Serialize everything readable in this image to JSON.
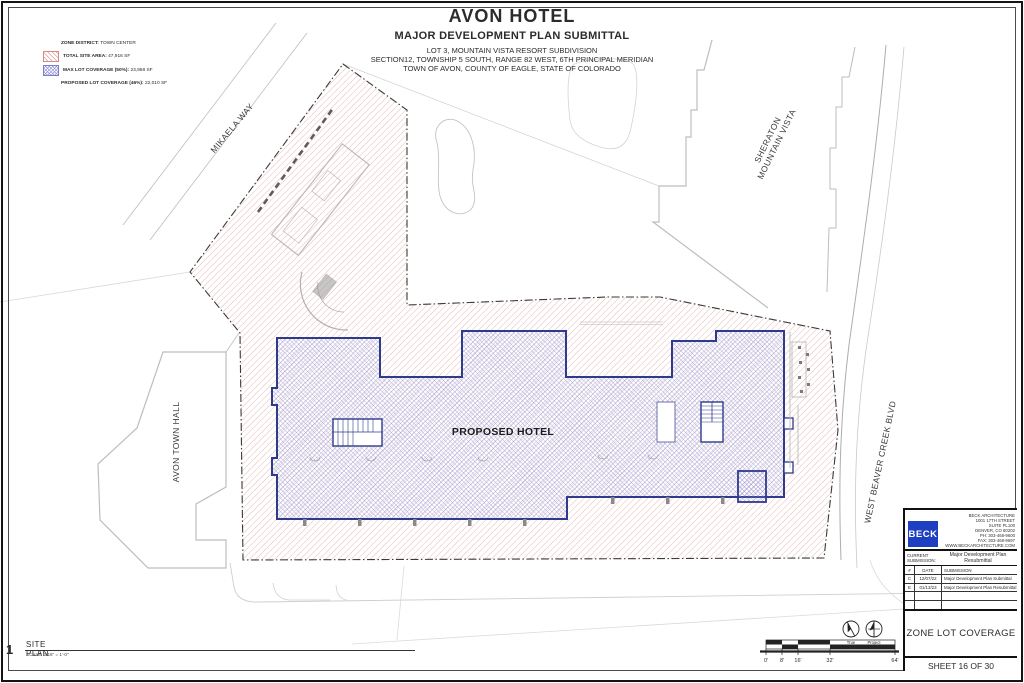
{
  "sheet_header": {
    "title": "AVON HOTEL",
    "subtitle": "MAJOR DEVELOPMENT PLAN SUBMITTAL",
    "legal_lines": [
      "LOT 3, MOUNTAIN VISTA RESORT SUBDIVISION",
      "SECTION12, TOWNSHIP 5 SOUTH, RANGE 82 WEST, 6TH PRINCIPAL MERIDIAN",
      "TOWN OF AVON, COUNTY OF EAGLE, STATE OF COLORADO"
    ]
  },
  "legend": {
    "zone_district": {
      "label": "ZONE DISTRICT:",
      "value": "TOWN CENTER"
    },
    "total_site_area": {
      "label": "TOTAL SITE AREA:",
      "value": "47,916 SF",
      "swatch": "red-diagonal-hatch"
    },
    "max_lot_coverage": {
      "label": "MAX LOT COVERAGE (50%):",
      "value": "23,958 SF",
      "swatch": "blue-cross-hatch"
    },
    "proposed_lot_coverage": {
      "label": "PROPOSED LOT COVERAGE (46%):",
      "value": "22,010 SF"
    }
  },
  "plan_labels": {
    "mikaela_way": "MIKAELA WAY",
    "avon_town_hall": "AVON TOWN HALL",
    "sheraton_line1": "SHERATON",
    "sheraton_line2": "MOUNTAIN VISTA",
    "west_beaver_creek_blvd": "WEST BEAVER CREEK BLVD",
    "proposed_hotel": "PROPOSED HOTEL"
  },
  "colors": {
    "site_area_hatch": "#DD9D97",
    "lot_coverage_hatch": "#9595DA",
    "building_outline": "#2E3A8C",
    "beck_logo_blue": "#1E3FBF"
  },
  "drawing_title": {
    "number": "1",
    "name": "SITE PLAN",
    "scale": "SCALE:  1/16\" = 1'-0\""
  },
  "scale_bar": {
    "ticks": [
      "0'",
      "8'",
      "16'",
      "32'",
      "64'"
    ]
  },
  "north_arrows": {
    "true_line1": "True",
    "true_line2": "North",
    "project_line1": "Project",
    "project_line2": "North"
  },
  "title_block": {
    "firm": {
      "logo_text": "BECK",
      "address_lines": [
        "BECK ARCHITECTURE",
        "1001 17TH STREET",
        "SUITE PL100",
        "DENVER, CO 80202",
        "PH: 303-468-9600",
        "FAX: 303-468-9697",
        "WWW.BECKARCHITECTURE.COM"
      ]
    },
    "current_submission": {
      "label": "CURRENT SUBMISSION:",
      "value": "Major Development Plan Resubmittal"
    },
    "submissions_table": {
      "headers": [
        "#",
        "DATE",
        "SUBMISSION"
      ],
      "rows": [
        {
          "id": "C",
          "date": "12/07/22",
          "name": "Major Development Plan Submittal"
        },
        {
          "id": "E",
          "date": "01/13/23",
          "name": "Major Development Plan Resubmittal"
        }
      ]
    },
    "sheet_title": "ZONE LOT COVERAGE",
    "sheet_number": "SHEET 16 OF 30"
  }
}
